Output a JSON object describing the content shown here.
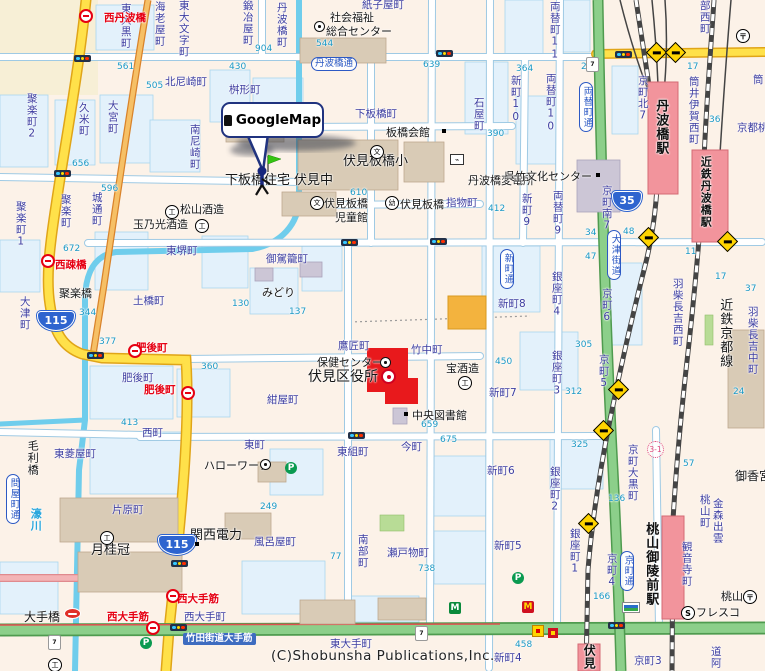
{
  "map": {
    "balloon_label": "GoogleMap",
    "copyright": "(C)Shobunsha Publications,Inc.",
    "accent_colors": {
      "station_pink": "#f2949c",
      "ward_office_red": "#e8191c",
      "route_blue": "#2e64cf",
      "road_yellow": "#ffe14a",
      "road_green": "#8ccf8a",
      "town_label": "#3c3ca0",
      "bus_red": "#e60012",
      "water": "#6fcdec"
    }
  },
  "route_shields": [
    {
      "n": "115",
      "x": 37,
      "y": 311,
      "w": 36
    },
    {
      "n": "115",
      "x": 158,
      "y": 535,
      "w": 36
    },
    {
      "n": "35",
      "x": 612,
      "y": 191,
      "w": 28
    }
  ],
  "labels": [
    {
      "t": "東大黒町",
      "x": 120,
      "y": 3,
      "k": "t",
      "v": 1
    },
    {
      "t": "海老屋町",
      "x": 154,
      "y": 1,
      "k": "t",
      "v": 1
    },
    {
      "t": "東大文字町",
      "x": 178,
      "y": 0,
      "k": "t",
      "v": 1
    },
    {
      "t": "鍛冶屋町",
      "x": 242,
      "y": 0,
      "k": "t",
      "v": 1
    },
    {
      "t": "紙子屋町",
      "x": 362,
      "y": 0,
      "k": "t"
    },
    {
      "t": "北尼崎町",
      "x": 165,
      "y": 77,
      "k": "t"
    },
    {
      "t": "桝形町",
      "x": 229,
      "y": 85,
      "k": "t"
    },
    {
      "t": "南尼崎町",
      "x": 189,
      "y": 124,
      "k": "t",
      "v": 1
    },
    {
      "t": "丹波橋町",
      "x": 276,
      "y": 2,
      "k": "t",
      "v": 1
    },
    {
      "t": "久米町",
      "x": 78,
      "y": 102,
      "k": "t",
      "v": 1
    },
    {
      "t": "大宮町",
      "x": 107,
      "y": 100,
      "k": "t",
      "v": 1
    },
    {
      "t": "聚楽町2",
      "x": 26,
      "y": 93,
      "k": "t",
      "v": 1
    },
    {
      "t": "聚楽町1",
      "x": 15,
      "y": 201,
      "k": "t",
      "v": 1
    },
    {
      "t": "聚楽町",
      "x": 60,
      "y": 194,
      "k": "t",
      "v": 1
    },
    {
      "t": "城通町",
      "x": 91,
      "y": 192,
      "k": "t",
      "v": 1
    },
    {
      "t": "下板橋町",
      "x": 355,
      "y": 109,
      "k": "t"
    },
    {
      "t": "石屋町",
      "x": 473,
      "y": 97,
      "k": "t",
      "v": 1
    },
    {
      "t": "指物町",
      "x": 446,
      "y": 198,
      "k": "t"
    },
    {
      "t": "東堺町",
      "x": 166,
      "y": 246,
      "k": "t"
    },
    {
      "t": "御駕籠町",
      "x": 266,
      "y": 254,
      "k": "t"
    },
    {
      "t": "土橋町",
      "x": 133,
      "y": 296,
      "k": "t"
    },
    {
      "t": "大津町",
      "x": 19,
      "y": 296,
      "k": "t",
      "v": 1
    },
    {
      "t": "肥後町",
      "x": 122,
      "y": 373,
      "k": "t"
    },
    {
      "t": "紺屋町",
      "x": 267,
      "y": 395,
      "k": "t"
    },
    {
      "t": "鷹匠町",
      "x": 338,
      "y": 341,
      "k": "t"
    },
    {
      "t": "竹中町",
      "x": 411,
      "y": 345,
      "k": "t"
    },
    {
      "t": "西町",
      "x": 142,
      "y": 428,
      "k": "t"
    },
    {
      "t": "東町",
      "x": 244,
      "y": 440,
      "k": "t"
    },
    {
      "t": "東菱屋町",
      "x": 54,
      "y": 449,
      "k": "t"
    },
    {
      "t": "片原町",
      "x": 112,
      "y": 505,
      "k": "t"
    },
    {
      "t": "風呂屋町",
      "x": 254,
      "y": 537,
      "k": "t"
    },
    {
      "t": "南部町",
      "x": 357,
      "y": 534,
      "k": "t",
      "v": 1
    },
    {
      "t": "瀬戸物町",
      "x": 387,
      "y": 548,
      "k": "t"
    },
    {
      "t": "今町",
      "x": 401,
      "y": 442,
      "k": "t"
    },
    {
      "t": "東組町",
      "x": 337,
      "y": 447,
      "k": "t"
    },
    {
      "t": "西大手町",
      "x": 184,
      "y": 612,
      "k": "t"
    },
    {
      "t": "東大手町",
      "x": 330,
      "y": 639,
      "k": "t"
    },
    {
      "t": "両替町11",
      "x": 549,
      "y": 1,
      "k": "t",
      "v": 1
    },
    {
      "t": "新町10",
      "x": 510,
      "y": 75,
      "k": "t",
      "v": 1
    },
    {
      "t": "両替町10",
      "x": 545,
      "y": 73,
      "k": "t",
      "v": 1
    },
    {
      "t": "京町北7",
      "x": 637,
      "y": 75,
      "k": "t",
      "v": 1
    },
    {
      "t": "部西町",
      "x": 699,
      "y": 0,
      "k": "t",
      "v": 1
    },
    {
      "t": "筒井伊賀西町",
      "x": 688,
      "y": 76,
      "k": "t",
      "v": 1
    },
    {
      "t": "筒",
      "x": 752,
      "y": 74,
      "k": "t",
      "v": 1
    },
    {
      "t": "新町9",
      "x": 521,
      "y": 193,
      "k": "t",
      "v": 1
    },
    {
      "t": "両替町9",
      "x": 552,
      "y": 190,
      "k": "t",
      "v": 1
    },
    {
      "t": "京町南7",
      "x": 601,
      "y": 185,
      "k": "t",
      "v": 1
    },
    {
      "t": "新町8",
      "x": 498,
      "y": 299,
      "k": "t"
    },
    {
      "t": "銀座町4",
      "x": 551,
      "y": 271,
      "k": "t",
      "v": 1
    },
    {
      "t": "銀座町3",
      "x": 551,
      "y": 350,
      "k": "t",
      "v": 1
    },
    {
      "t": "銀座町2",
      "x": 549,
      "y": 466,
      "k": "t",
      "v": 1
    },
    {
      "t": "銀座町1",
      "x": 569,
      "y": 528,
      "k": "t",
      "v": 1
    },
    {
      "t": "京町6",
      "x": 601,
      "y": 288,
      "k": "t",
      "v": 1
    },
    {
      "t": "京町5",
      "x": 598,
      "y": 354,
      "k": "t",
      "v": 1
    },
    {
      "t": "京町4",
      "x": 606,
      "y": 553,
      "k": "t",
      "v": 1
    },
    {
      "t": "京町大黒町",
      "x": 627,
      "y": 444,
      "k": "t",
      "v": 1
    },
    {
      "t": "京町3",
      "x": 634,
      "y": 656,
      "k": "t"
    },
    {
      "t": "羽柴長吉西町",
      "x": 672,
      "y": 278,
      "k": "t",
      "v": 1
    },
    {
      "t": "羽柴長吉中町",
      "x": 747,
      "y": 306,
      "k": "t",
      "v": 1
    },
    {
      "t": "観音寺町",
      "x": 681,
      "y": 541,
      "k": "t",
      "v": 1
    },
    {
      "t": "桃山町",
      "x": 699,
      "y": 494,
      "k": "t",
      "v": 1
    },
    {
      "t": "金森出雲",
      "x": 712,
      "y": 498,
      "k": "t",
      "v": 1
    },
    {
      "t": "道阿",
      "x": 710,
      "y": 646,
      "k": "t",
      "v": 1
    },
    {
      "t": "新町7",
      "x": 489,
      "y": 388,
      "k": "t"
    },
    {
      "t": "新町6",
      "x": 487,
      "y": 466,
      "k": "t"
    },
    {
      "t": "新町5",
      "x": 494,
      "y": 541,
      "k": "t"
    },
    {
      "t": "新町4",
      "x": 494,
      "y": 653,
      "k": "t"
    },
    {
      "t": "京都桃",
      "x": 737,
      "y": 123,
      "k": "t"
    },
    {
      "t": "社会福祉",
      "x": 330,
      "y": 12,
      "k": "p"
    },
    {
      "t": "総合センター",
      "x": 326,
      "y": 26,
      "k": "p"
    },
    {
      "t": "板橋会館",
      "x": 386,
      "y": 127,
      "k": "p"
    },
    {
      "t": "伏見板橋小",
      "x": 343,
      "y": 155,
      "k": "p",
      "s": 13
    },
    {
      "t": "伏見中",
      "x": 294,
      "y": 174,
      "k": "p",
      "s": 13
    },
    {
      "t": "下板橋住宅",
      "x": 225,
      "y": 174,
      "k": "p",
      "s": 13
    },
    {
      "t": "伏見板橋",
      "x": 324,
      "y": 198,
      "k": "p"
    },
    {
      "t": "児童館",
      "x": 335,
      "y": 212,
      "k": "p"
    },
    {
      "t": "伏見板橋",
      "x": 400,
      "y": 199,
      "k": "p"
    },
    {
      "t": "丹波橋変電所",
      "x": 468,
      "y": 175,
      "k": "p"
    },
    {
      "t": "呉竹文化センター",
      "x": 504,
      "y": 171,
      "k": "p"
    },
    {
      "t": "松山酒造",
      "x": 180,
      "y": 204,
      "k": "p"
    },
    {
      "t": "玉乃光酒造",
      "x": 133,
      "y": 219,
      "k": "p"
    },
    {
      "t": "みどり",
      "x": 262,
      "y": 287,
      "k": "p"
    },
    {
      "t": "保健センター",
      "x": 317,
      "y": 357,
      "k": "p"
    },
    {
      "t": "伏見区役所",
      "x": 308,
      "y": 370,
      "k": "p",
      "s": 14
    },
    {
      "t": "宝酒造",
      "x": 446,
      "y": 363,
      "k": "p"
    },
    {
      "t": "中央図書館",
      "x": 412,
      "y": 410,
      "k": "p"
    },
    {
      "t": "月桂冠",
      "x": 91,
      "y": 544,
      "k": "p",
      "s": 13
    },
    {
      "t": "関西電力",
      "x": 190,
      "y": 529,
      "k": "p",
      "s": 13
    },
    {
      "t": "ハローワーク",
      "x": 204,
      "y": 460,
      "k": "p"
    },
    {
      "t": "大手橋",
      "x": 24,
      "y": 611,
      "k": "p",
      "s": 12
    },
    {
      "t": "毛利橋",
      "x": 27,
      "y": 440,
      "k": "p",
      "v": 1
    },
    {
      "t": "聚楽橋",
      "x": 59,
      "y": 288,
      "k": "p"
    },
    {
      "t": "御香宮",
      "x": 735,
      "y": 470,
      "k": "p",
      "s": 12
    },
    {
      "t": "桃山",
      "x": 721,
      "y": 591,
      "k": "p"
    },
    {
      "t": "フレスコ",
      "x": 696,
      "y": 607,
      "k": "p"
    },
    {
      "t": "近鉄京都線",
      "x": 718,
      "y": 298,
      "k": "p",
      "v": 1,
      "s": 13
    },
    {
      "t": "丹波橋駅",
      "x": 654,
      "y": 99,
      "k": "st",
      "v": 1,
      "s": 13
    },
    {
      "t": "近鉄丹波橋駅",
      "x": 700,
      "y": 156,
      "k": "st",
      "v": 1,
      "s": 11
    },
    {
      "t": "桃山御陵前駅",
      "x": 644,
      "y": 522,
      "k": "st",
      "v": 1,
      "s": 13
    },
    {
      "t": "伏見",
      "x": 583,
      "y": 644,
      "k": "st",
      "v": 1,
      "s": 12
    },
    {
      "t": "西丹波橋",
      "x": 104,
      "y": 13,
      "k": "r"
    },
    {
      "t": "西疎橋",
      "x": 55,
      "y": 260,
      "k": "r"
    },
    {
      "t": "肥後町",
      "x": 136,
      "y": 343,
      "k": "r"
    },
    {
      "t": "肥後町",
      "x": 144,
      "y": 385,
      "k": "r"
    },
    {
      "t": "西大手筋",
      "x": 107,
      "y": 612,
      "k": "r"
    },
    {
      "t": "西大手筋",
      "x": 177,
      "y": 594,
      "k": "r"
    },
    {
      "t": "濠川",
      "x": 30,
      "y": 508,
      "k": "w",
      "v": 1
    },
    {
      "t": "丹波橋通",
      "x": 311,
      "y": 57,
      "k": "o"
    },
    {
      "t": "両替町通",
      "x": 579,
      "y": 82,
      "k": "o",
      "v": 1
    },
    {
      "t": "大津街道",
      "x": 607,
      "y": 230,
      "k": "o",
      "v": 1
    },
    {
      "t": "新町通",
      "x": 500,
      "y": 249,
      "k": "o",
      "v": 1
    },
    {
      "t": "京町通",
      "x": 620,
      "y": 551,
      "k": "o",
      "v": 1
    },
    {
      "t": "問屋町通",
      "x": 6,
      "y": 474,
      "k": "o",
      "v": 1
    },
    {
      "t": "竹田街道大手筋",
      "x": 183,
      "y": 633,
      "k": "rd"
    },
    {
      "t": "3-1",
      "x": 647,
      "y": 441,
      "k": "ch"
    },
    {
      "t": "561",
      "x": 117,
      "y": 63,
      "k": "n"
    },
    {
      "t": "505",
      "x": 146,
      "y": 82,
      "k": "n"
    },
    {
      "t": "430",
      "x": 229,
      "y": 63,
      "k": "n"
    },
    {
      "t": "656",
      "x": 72,
      "y": 160,
      "k": "n"
    },
    {
      "t": "596",
      "x": 101,
      "y": 185,
      "k": "n"
    },
    {
      "t": "904",
      "x": 255,
      "y": 45,
      "k": "n"
    },
    {
      "t": "544",
      "x": 316,
      "y": 40,
      "k": "n"
    },
    {
      "t": "639",
      "x": 423,
      "y": 61,
      "k": "n"
    },
    {
      "t": "364",
      "x": 516,
      "y": 65,
      "k": "n"
    },
    {
      "t": "222",
      "x": 581,
      "y": 63,
      "k": "n"
    },
    {
      "t": "17",
      "x": 687,
      "y": 63,
      "k": "n"
    },
    {
      "t": "377",
      "x": 99,
      "y": 338,
      "k": "n"
    },
    {
      "t": "390",
      "x": 487,
      "y": 130,
      "k": "n"
    },
    {
      "t": "36",
      "x": 709,
      "y": 116,
      "k": "n"
    },
    {
      "t": "11",
      "x": 685,
      "y": 248,
      "k": "n"
    },
    {
      "t": "17",
      "x": 715,
      "y": 273,
      "k": "n"
    },
    {
      "t": "37",
      "x": 745,
      "y": 285,
      "k": "n"
    },
    {
      "t": "34",
      "x": 585,
      "y": 229,
      "k": "n"
    },
    {
      "t": "48",
      "x": 623,
      "y": 228,
      "k": "n"
    },
    {
      "t": "47",
      "x": 585,
      "y": 253,
      "k": "n"
    },
    {
      "t": "305",
      "x": 575,
      "y": 341,
      "k": "n"
    },
    {
      "t": "312",
      "x": 565,
      "y": 388,
      "k": "n"
    },
    {
      "t": "24",
      "x": 733,
      "y": 388,
      "k": "n"
    },
    {
      "t": "325",
      "x": 571,
      "y": 441,
      "k": "n"
    },
    {
      "t": "136",
      "x": 608,
      "y": 495,
      "k": "n"
    },
    {
      "t": "166",
      "x": 593,
      "y": 593,
      "k": "n"
    },
    {
      "t": "57",
      "x": 683,
      "y": 460,
      "k": "n"
    },
    {
      "t": "458",
      "x": 515,
      "y": 641,
      "k": "n"
    },
    {
      "t": "672",
      "x": 63,
      "y": 245,
      "k": "n"
    },
    {
      "t": "344",
      "x": 79,
      "y": 309,
      "k": "n"
    },
    {
      "t": "130",
      "x": 232,
      "y": 300,
      "k": "n"
    },
    {
      "t": "137",
      "x": 289,
      "y": 308,
      "k": "n"
    },
    {
      "t": "450",
      "x": 495,
      "y": 358,
      "k": "n"
    },
    {
      "t": "412",
      "x": 488,
      "y": 205,
      "k": "n"
    },
    {
      "t": "610",
      "x": 350,
      "y": 189,
      "k": "n"
    },
    {
      "t": "675",
      "x": 440,
      "y": 436,
      "k": "n"
    },
    {
      "t": "659",
      "x": 421,
      "y": 421,
      "k": "n"
    },
    {
      "t": "738",
      "x": 418,
      "y": 565,
      "k": "n"
    },
    {
      "t": "249",
      "x": 260,
      "y": 503,
      "k": "n"
    },
    {
      "t": "77",
      "x": 330,
      "y": 553,
      "k": "n"
    },
    {
      "t": "413",
      "x": 121,
      "y": 419,
      "k": "n"
    },
    {
      "t": "360",
      "x": 201,
      "y": 363,
      "k": "n"
    }
  ],
  "icons": [
    {
      "ty": "traffic-light",
      "x": 74,
      "y": 55
    },
    {
      "ty": "traffic-light",
      "x": 54,
      "y": 170
    },
    {
      "ty": "traffic-light",
      "x": 87,
      "y": 352
    },
    {
      "ty": "traffic-light",
      "x": 341,
      "y": 239
    },
    {
      "ty": "traffic-light",
      "x": 430,
      "y": 238
    },
    {
      "ty": "traffic-light",
      "x": 436,
      "y": 50
    },
    {
      "ty": "traffic-light",
      "x": 615,
      "y": 51
    },
    {
      "ty": "traffic-light",
      "x": 348,
      "y": 432
    },
    {
      "ty": "traffic-light",
      "x": 170,
      "y": 624
    },
    {
      "ty": "traffic-light",
      "x": 608,
      "y": 622
    },
    {
      "ty": "traffic-light",
      "x": 171,
      "y": 560
    },
    {
      "ty": "rail-crossing",
      "x": 641,
      "y": 230
    },
    {
      "ty": "rail-crossing",
      "x": 611,
      "y": 382
    },
    {
      "ty": "rail-crossing",
      "x": 596,
      "y": 423
    },
    {
      "ty": "rail-crossing",
      "x": 581,
      "y": 516
    },
    {
      "ty": "rail-crossing",
      "x": 649,
      "y": 45
    },
    {
      "ty": "rail-crossing",
      "x": 668,
      "y": 45
    },
    {
      "ty": "rail-crossing",
      "x": 720,
      "y": 234
    },
    {
      "ty": "bus-stop",
      "x": 79,
      "y": 9
    },
    {
      "ty": "bus-stop",
      "x": 41,
      "y": 254
    },
    {
      "ty": "bus-stop",
      "x": 128,
      "y": 344
    },
    {
      "ty": "bus-stop",
      "x": 181,
      "y": 386
    },
    {
      "ty": "bus-stop",
      "x": 166,
      "y": 589
    },
    {
      "ty": "bus-stop",
      "x": 146,
      "y": 621
    },
    {
      "ty": "seven-eleven",
      "x": 586,
      "y": 57,
      "g": "7"
    },
    {
      "ty": "seven-eleven",
      "x": 48,
      "y": 635,
      "g": "7"
    },
    {
      "ty": "seven-eleven",
      "x": 415,
      "y": 626,
      "g": "7"
    },
    {
      "ty": "mcdonalds",
      "x": 522,
      "y": 601,
      "g": "M"
    },
    {
      "ty": "bank-m",
      "x": 449,
      "y": 602,
      "g": "M"
    },
    {
      "ty": "familymart",
      "x": 622,
      "y": 602
    },
    {
      "ty": "fresco-s",
      "x": 681,
      "y": 606,
      "g": "S"
    },
    {
      "ty": "parking",
      "x": 285,
      "y": 462,
      "g": "P"
    },
    {
      "ty": "parking",
      "x": 512,
      "y": 572,
      "g": "P"
    },
    {
      "ty": "parking",
      "x": 140,
      "y": 637,
      "g": "P"
    },
    {
      "ty": "store-red-oval",
      "x": 64,
      "y": 608
    },
    {
      "ty": "store-yellow",
      "x": 532,
      "y": 625
    },
    {
      "ty": "store-red",
      "x": 548,
      "y": 628
    },
    {
      "ty": "post-office",
      "x": 736,
      "y": 29,
      "g": "〒"
    },
    {
      "ty": "post-office",
      "x": 743,
      "y": 590,
      "g": "〒"
    },
    {
      "ty": "transformer",
      "x": 450,
      "y": 154,
      "g": "⌁"
    },
    {
      "ty": "school",
      "x": 370,
      "y": 145,
      "g": "文"
    },
    {
      "ty": "school",
      "x": 310,
      "y": 196,
      "g": "文"
    },
    {
      "ty": "factory",
      "x": 165,
      "y": 205,
      "g": "工"
    },
    {
      "ty": "factory",
      "x": 195,
      "y": 219,
      "g": "工"
    },
    {
      "ty": "factory",
      "x": 100,
      "y": 531,
      "g": "工"
    },
    {
      "ty": "factory",
      "x": 458,
      "y": 376,
      "g": "工"
    },
    {
      "ty": "factory",
      "x": 48,
      "y": 658,
      "g": "工"
    },
    {
      "ty": "kindergarten",
      "x": 385,
      "y": 196,
      "g": "幼"
    },
    {
      "ty": "gov-office",
      "x": 381,
      "y": 369
    },
    {
      "ty": "gov-circle",
      "x": 314,
      "y": 21
    },
    {
      "ty": "gov-circle",
      "x": 260,
      "y": 459
    },
    {
      "ty": "gov-circle",
      "x": 380,
      "y": 357
    },
    {
      "ty": "building-dot",
      "x": 442,
      "y": 129
    },
    {
      "ty": "building-dot",
      "x": 404,
      "y": 412
    },
    {
      "ty": "building-dot",
      "x": 195,
      "y": 542
    },
    {
      "ty": "building-dot",
      "x": 596,
      "y": 173
    }
  ]
}
